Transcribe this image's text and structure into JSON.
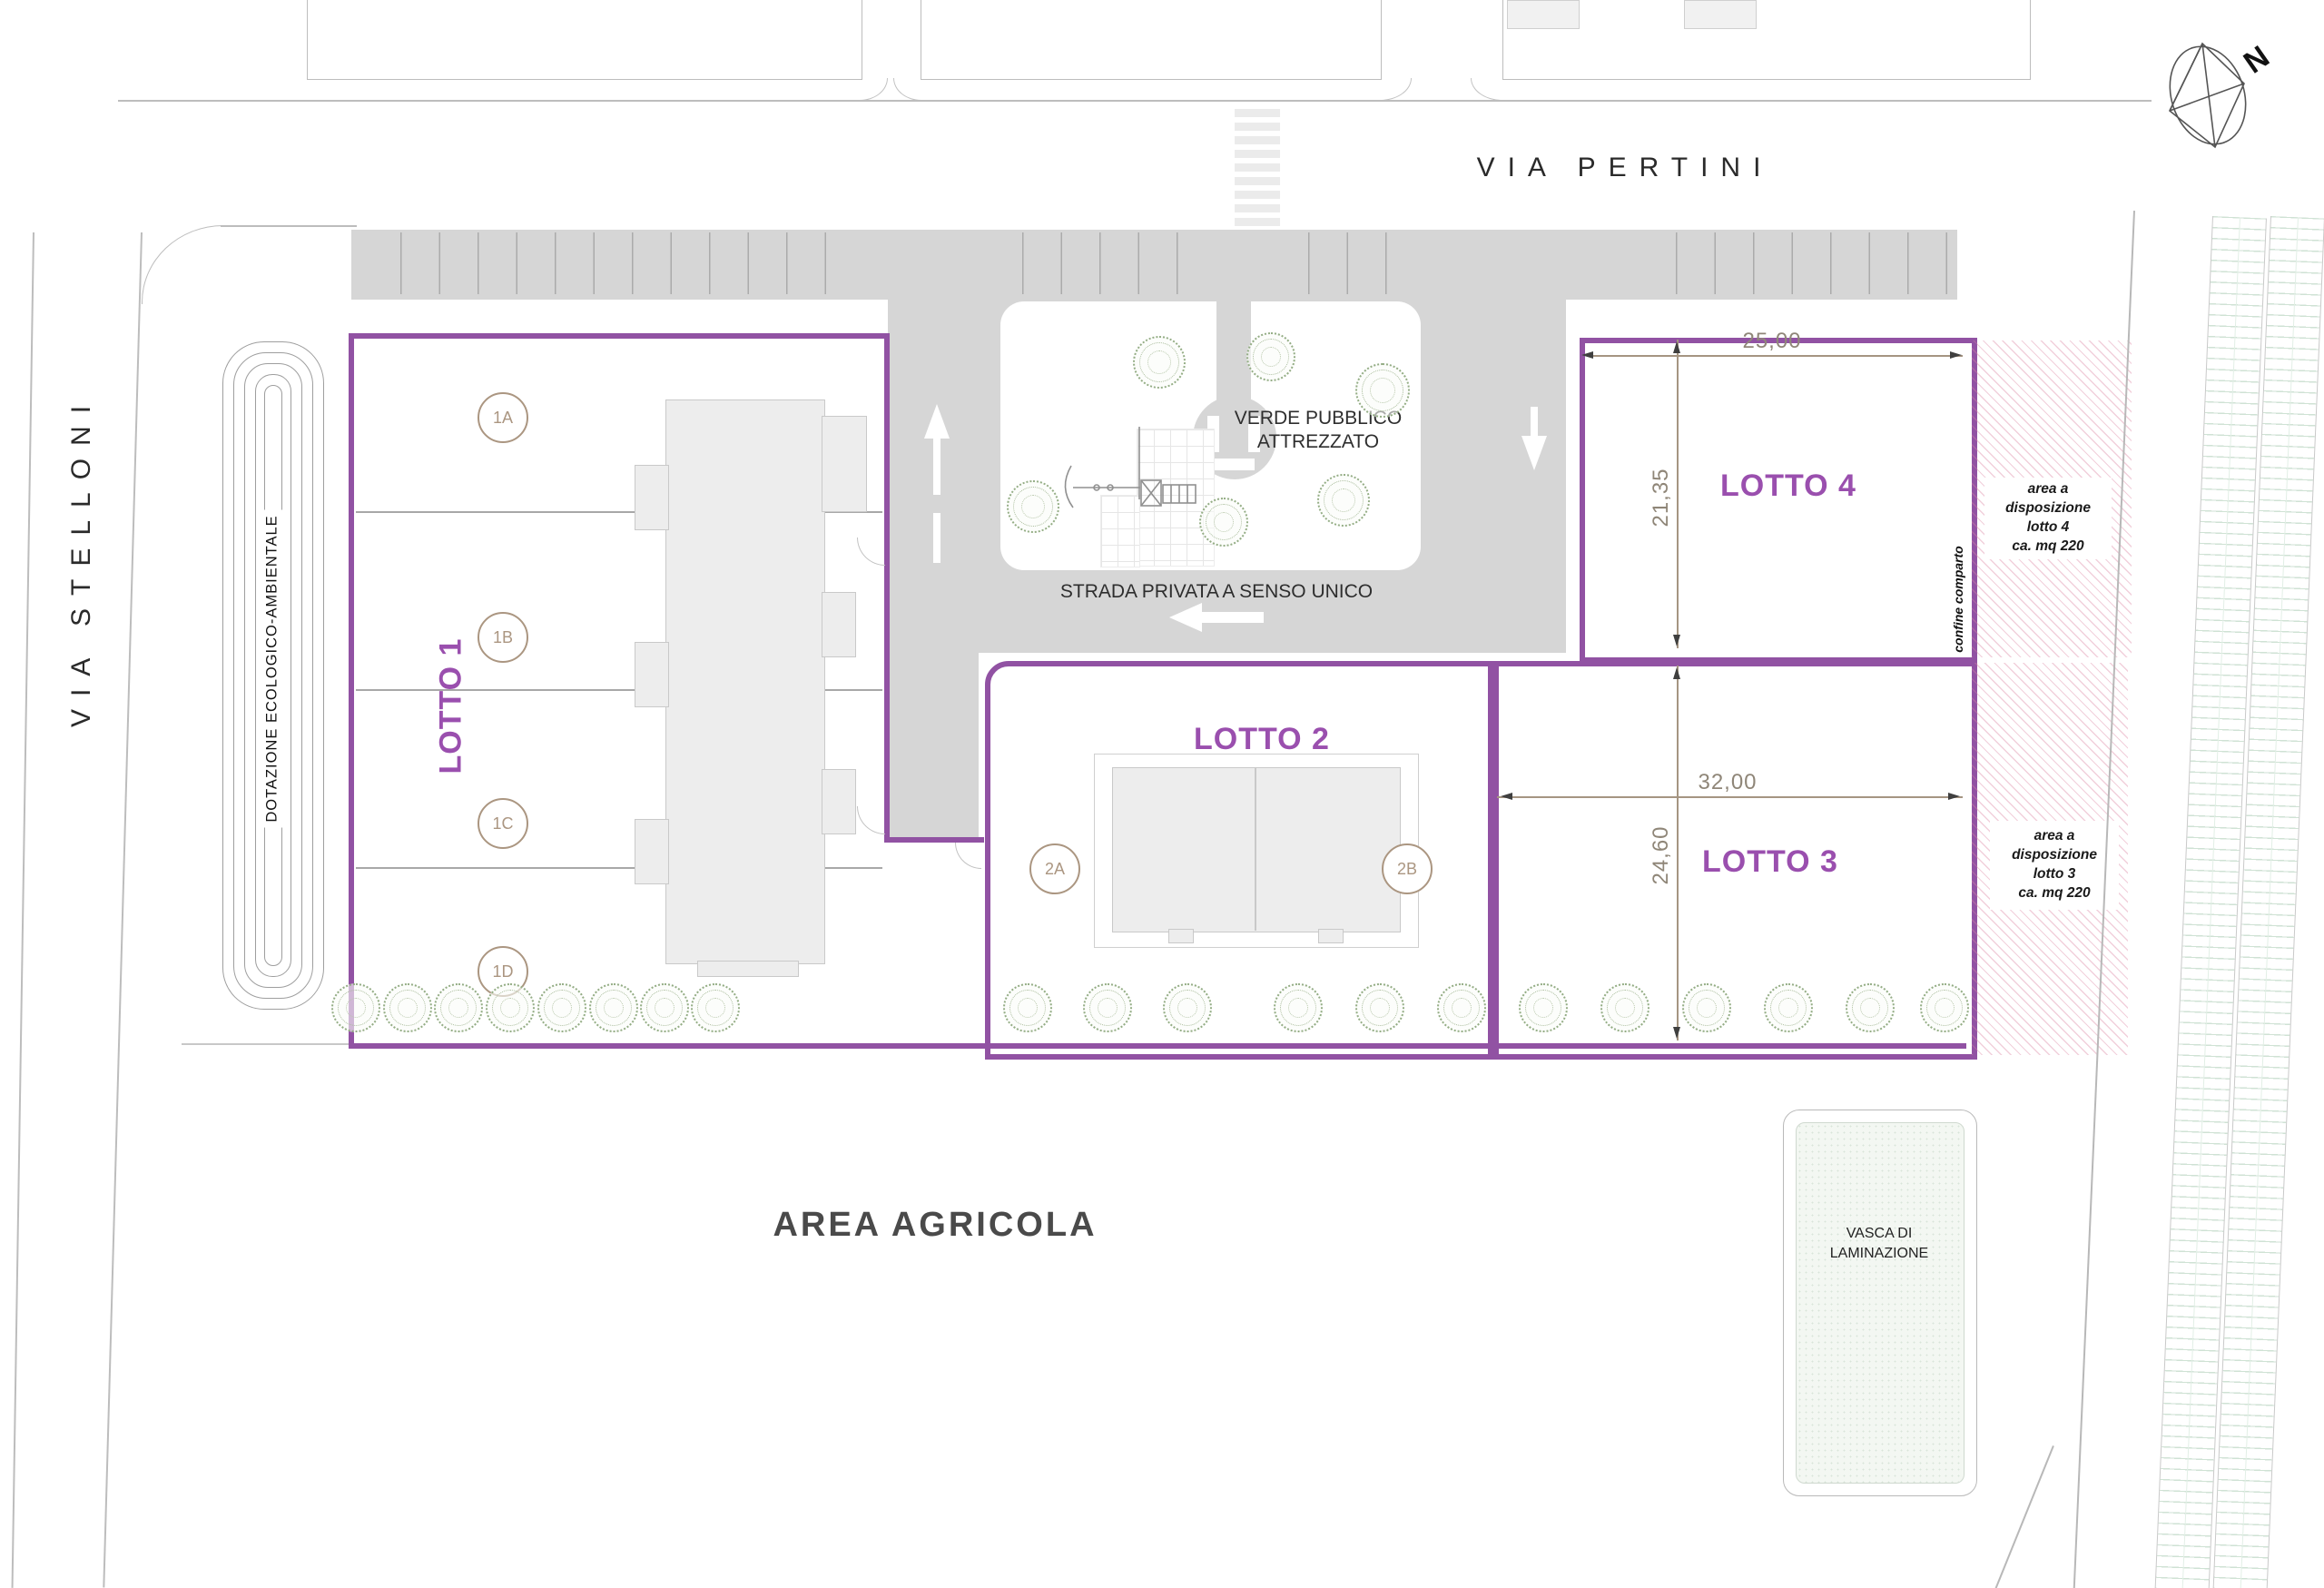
{
  "title": "Planimetria comparto residenziale",
  "streets": {
    "via_pertini": "VIA PERTINI",
    "via_stelloni": "VIA STELLONI"
  },
  "compass": {
    "north": "N"
  },
  "eco_strip": {
    "label": "DOTAZIONE ECOLOGICO-AMBIENTALE"
  },
  "park": {
    "label_line1": "VERDE PUBBLICO",
    "label_line2": "ATTREZZATO"
  },
  "road": {
    "private_road_label": "STRADA PRIVATA A SENSO UNICO"
  },
  "lots": {
    "lot1": {
      "name": "LOTTO 1",
      "units": [
        {
          "label": "1A"
        },
        {
          "label": "1B"
        },
        {
          "label": "1C"
        },
        {
          "label": "1D"
        }
      ]
    },
    "lot2": {
      "name": "LOTTO 2",
      "units": [
        {
          "label": "2A"
        },
        {
          "label": "2B"
        }
      ]
    },
    "lot3": {
      "name": "LOTTO 3",
      "width_m": "32,00",
      "height_m": "24,60",
      "reserve_note": {
        "line1": "area a",
        "line2": "disposizione",
        "line3": "lotto 3",
        "line4": "ca. mq 220"
      }
    },
    "lot4": {
      "name": "LOTTO 4",
      "width_m": "25,00",
      "height_m": "21,35",
      "reserve_note": {
        "line1": "area a",
        "line2": "disposizione",
        "line3": "lotto 4",
        "line4": "ca. mq 220"
      }
    }
  },
  "boundary": {
    "confine_label": "confine comparto"
  },
  "south": {
    "area_agricola": "AREA AGRICOLA",
    "vasca_line1": "VASCA DI",
    "vasca_line2": "LAMINAZIONE"
  },
  "colors": {
    "lot_boundary": "#9152a3",
    "lot_label": "#9a4fae",
    "road_gray": "#d6d6d6",
    "dimension_tan": "#a59582",
    "unit_circle_tan": "#ab9681",
    "tree_green": "#94ad85",
    "hatch_pink": "#e9b9cb",
    "field_green": "#cfe2d4"
  }
}
